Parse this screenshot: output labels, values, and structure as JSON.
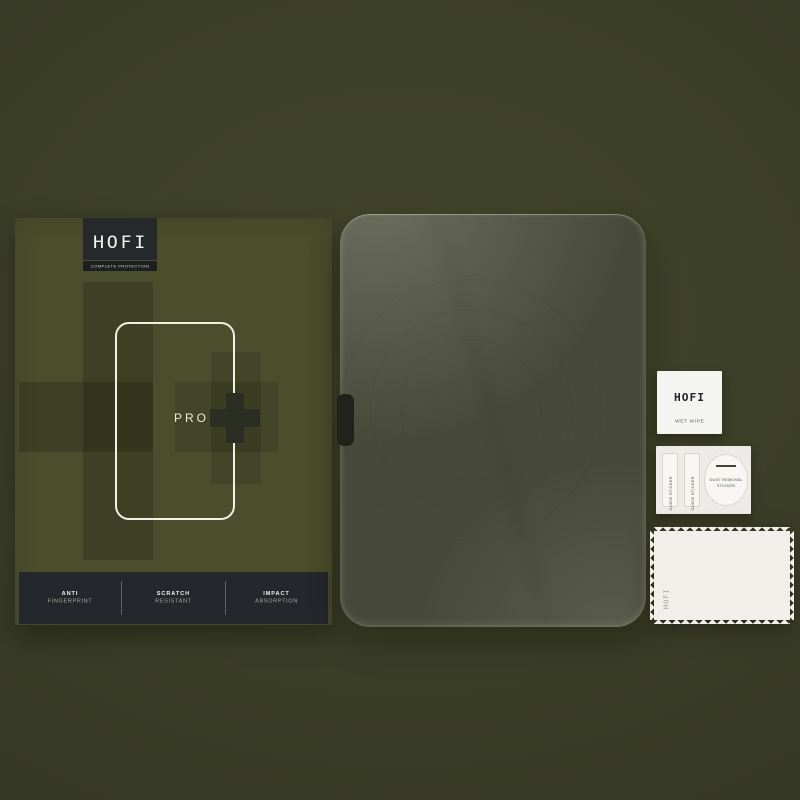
{
  "scene": {
    "description": "HOFI Pro+ tempered glass screen protector retail kit product photo"
  },
  "box": {
    "brand": "HOFI",
    "tagline": "COMPLETE PROTECTION",
    "model": "PRO",
    "plus": "+",
    "features": [
      {
        "line1": "ANTI",
        "line2": "FINGERPRINT"
      },
      {
        "line1": "SCRATCH",
        "line2": "RESISTANT"
      },
      {
        "line1": "IMPACT",
        "line2": "ABSORPTION"
      }
    ]
  },
  "accessories": {
    "wet_wipe": {
      "brand": "HOFI",
      "label": "WET WIPE"
    },
    "sticker_sheet": {
      "guide_sticker_left": "GUIDE STICKER",
      "guide_sticker_right": "GUIDE STICKER",
      "dust_removal_line1": "DUST REMOVAL",
      "dust_removal_line2": "STICKER"
    },
    "cloth": {
      "brand": "HOFI"
    }
  },
  "colors": {
    "background": "#3a3d26",
    "box_olive": "#4b4e2d",
    "dark_charcoal": "#24272a",
    "glass_tint": "#474a3a",
    "white": "#f0efe9"
  }
}
